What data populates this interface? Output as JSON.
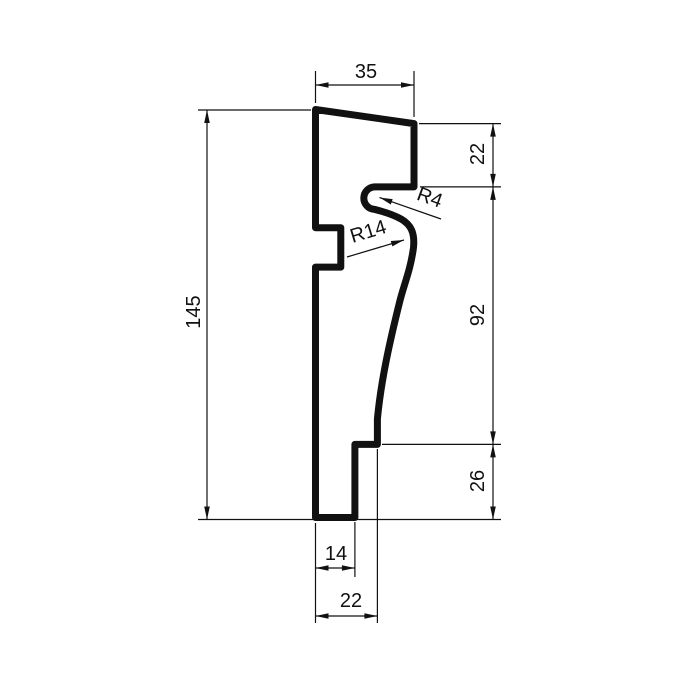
{
  "drawing": {
    "type": "technical-profile-cross-section",
    "background": "#ffffff",
    "line_color": "#111111",
    "dims": {
      "top_width": "35",
      "left_height": "145",
      "right_upper": "22",
      "right_middle": "92",
      "right_lower": "26",
      "bottom_inner": "14",
      "bottom_outer": "22"
    },
    "radii": {
      "drip_groove": "R4",
      "cove_curve": "R14"
    }
  }
}
